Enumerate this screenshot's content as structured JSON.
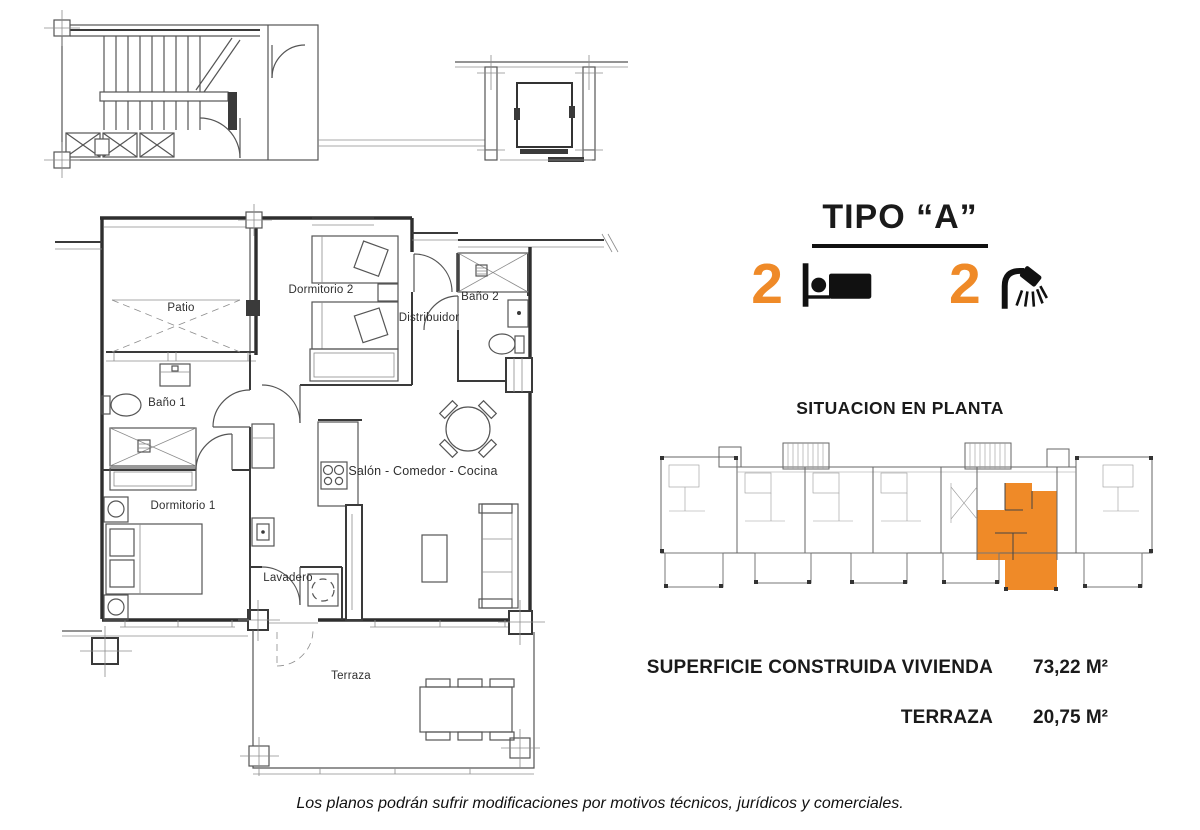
{
  "header": {
    "title": "TIPO “A”"
  },
  "features": {
    "bedrooms": "2",
    "bathrooms": "2",
    "accent_color": "#EF8A28"
  },
  "situation": {
    "heading": "SITUACION EN PLANTA"
  },
  "plan": {
    "rooms": {
      "patio": "Patio",
      "dormitorio2": "Dormitorio 2",
      "bano2": "Baño 2",
      "distribuidor": "Distribuidor",
      "bano1": "Baño 1",
      "dormitorio1": "Dormitorio 1",
      "salon": "Salón - Comedor - Cocina",
      "lavadero": "Lavadero",
      "terraza": "Terraza"
    }
  },
  "areas": [
    {
      "label": "SUPERFICIE CONSTRUIDA VIVIENDA",
      "value": "73,22 M²"
    },
    {
      "label": "TERRAZA",
      "value": "20,75 M²"
    }
  ],
  "footer": {
    "disclaimer": "Los planos podrán sufrir modificaciones por motivos técnicos, jurídicos y comerciales."
  }
}
